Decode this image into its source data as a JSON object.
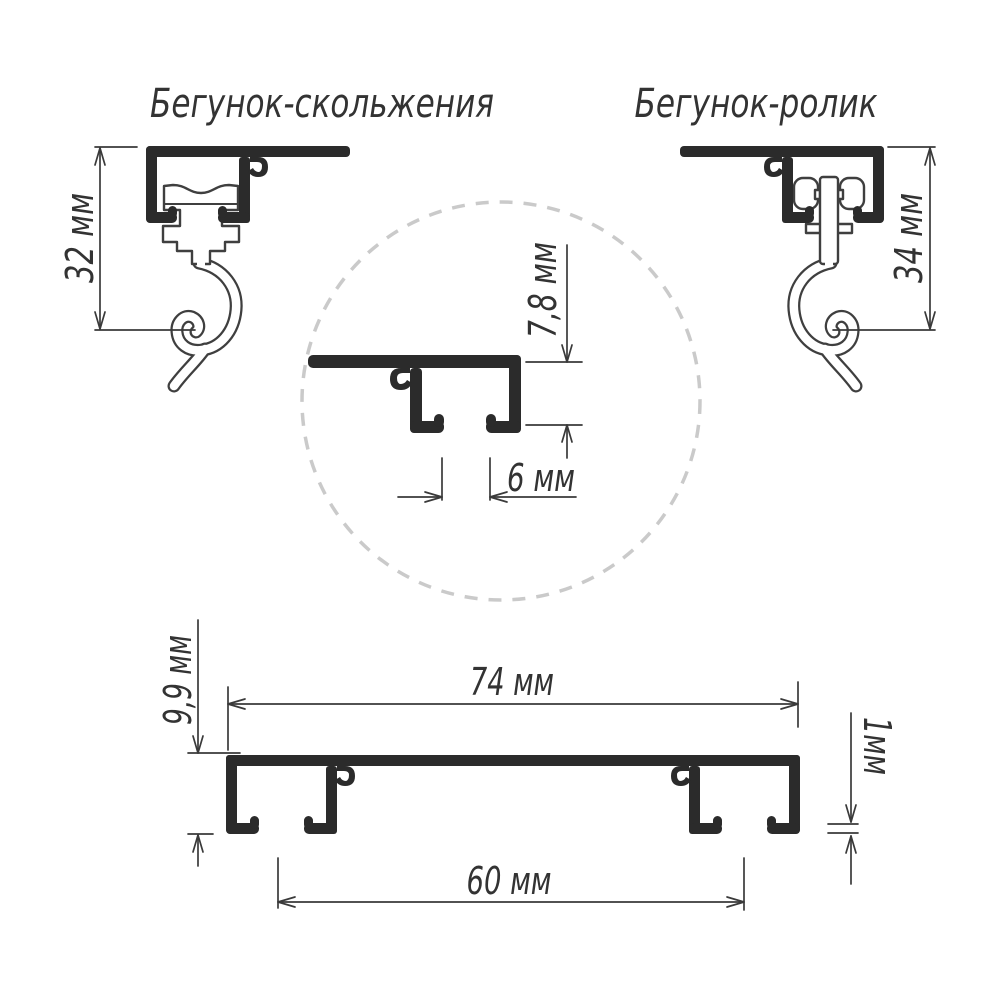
{
  "titles": {
    "slider": "Бегунок-скольжения",
    "roller": "Бегунок-ролик"
  },
  "dimensions": {
    "slider_height": "32 мм",
    "roller_height": "34 мм",
    "detail_channel_height": "7,8 мм",
    "detail_channel_gap": "6 мм",
    "profile_total_width": "74 мм",
    "profile_height": "9,9 мм",
    "channels_distance": "60 мм",
    "wall_thickness": "1мм"
  },
  "colors": {
    "profile_fill": "#2b2b2b",
    "outline": "#3f3f3f",
    "dimension_lines": "#3a3a3a",
    "text": "#333333",
    "dashed_circle": "#cacaca",
    "background": "#ffffff"
  }
}
